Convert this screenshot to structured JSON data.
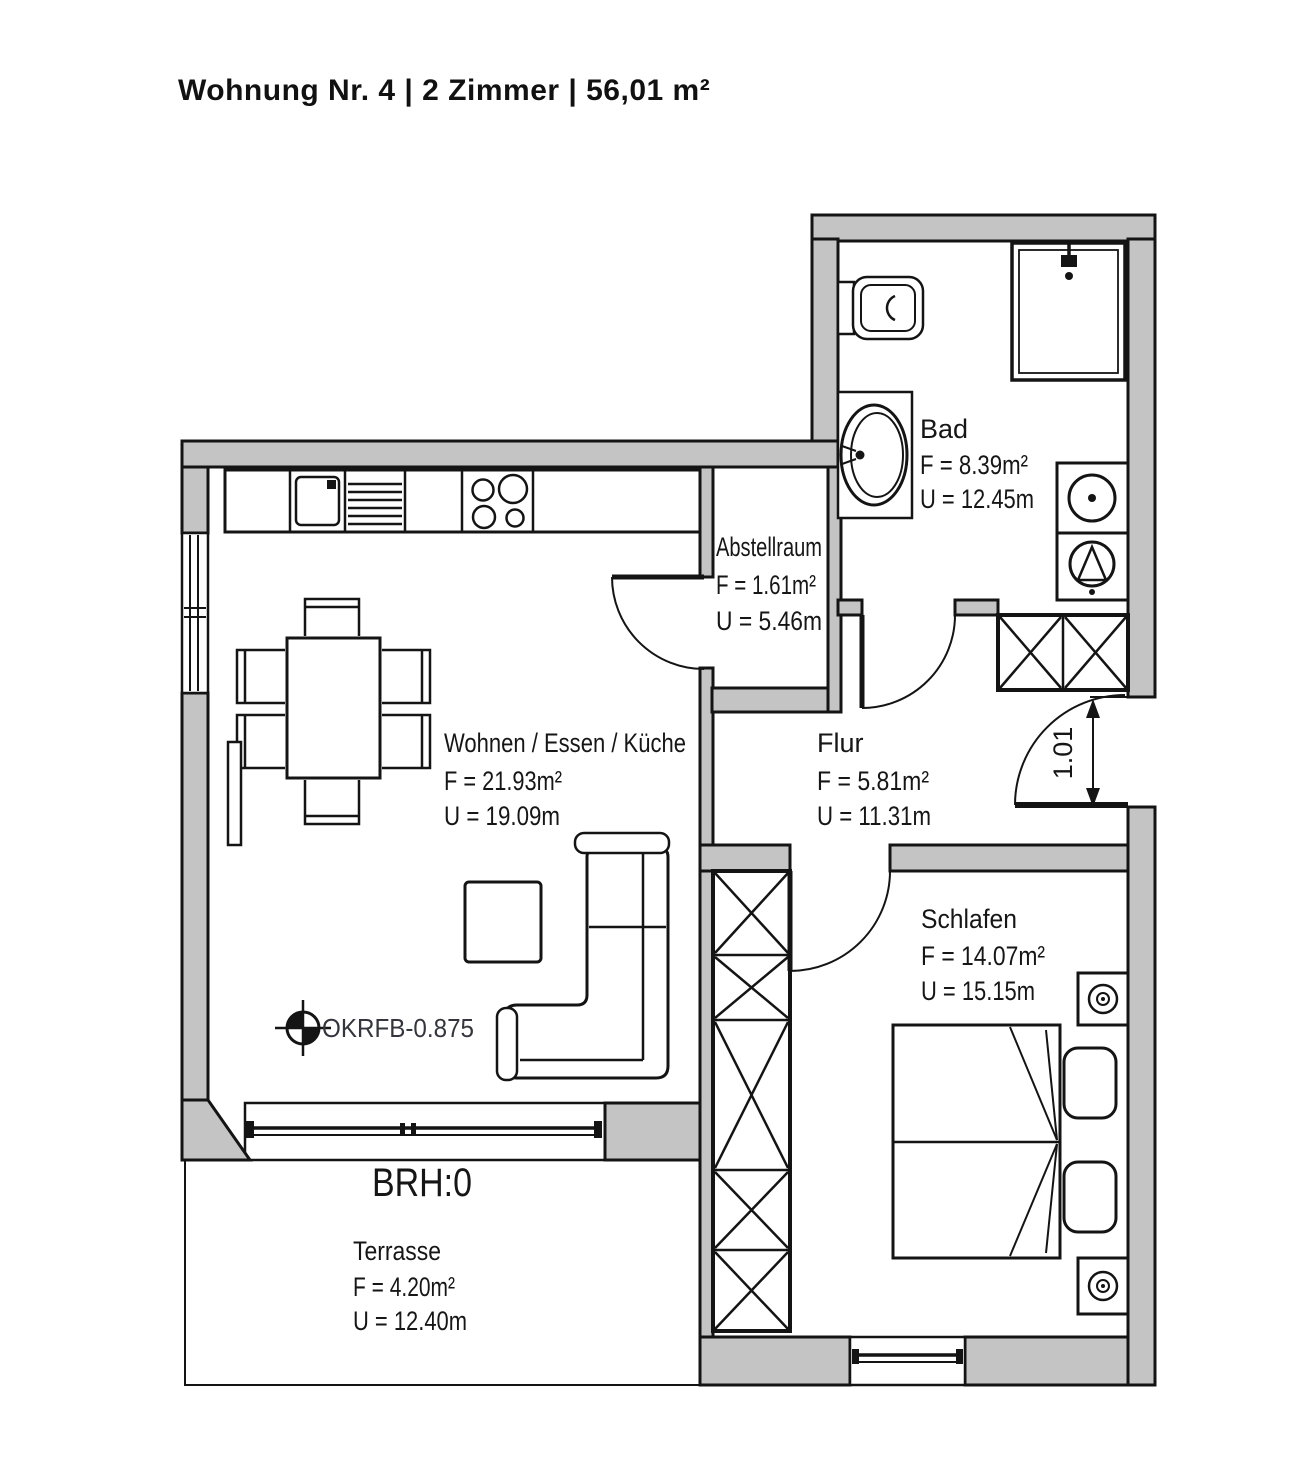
{
  "title": "Wohnung Nr. 4 | 2 Zimmer | 56,01 m²",
  "rooms": {
    "bad": {
      "name": "Bad",
      "area": "F = 8.39m²",
      "perimeter": "U = 12.45m"
    },
    "abstellraum": {
      "name": "Abstellraum",
      "area": "F = 1.61m²",
      "perimeter": "U = 5.46m"
    },
    "wohnen": {
      "name": "Wohnen / Essen / Küche",
      "area": "F = 21.93m²",
      "perimeter": "U = 19.09m"
    },
    "flur": {
      "name": "Flur",
      "area": "F = 5.81m²",
      "perimeter": "U = 11.31m"
    },
    "schlafen": {
      "name": "Schlafen",
      "area": "F = 14.07m²",
      "perimeter": "U = 15.15m"
    },
    "terrasse": {
      "name": "Terrasse",
      "area": "F = 4.20m²",
      "perimeter": "U = 12.40m"
    }
  },
  "annotations": {
    "floor_level": "OKRFB-0.875",
    "sill_height": "BRH:0",
    "entrance_door_width": "1.01"
  },
  "colors": {
    "background": "#ffffff",
    "wall_fill": "#c4c4c4",
    "line": "#141414",
    "label_text": "#161616",
    "annotation_text": "#34353d"
  }
}
